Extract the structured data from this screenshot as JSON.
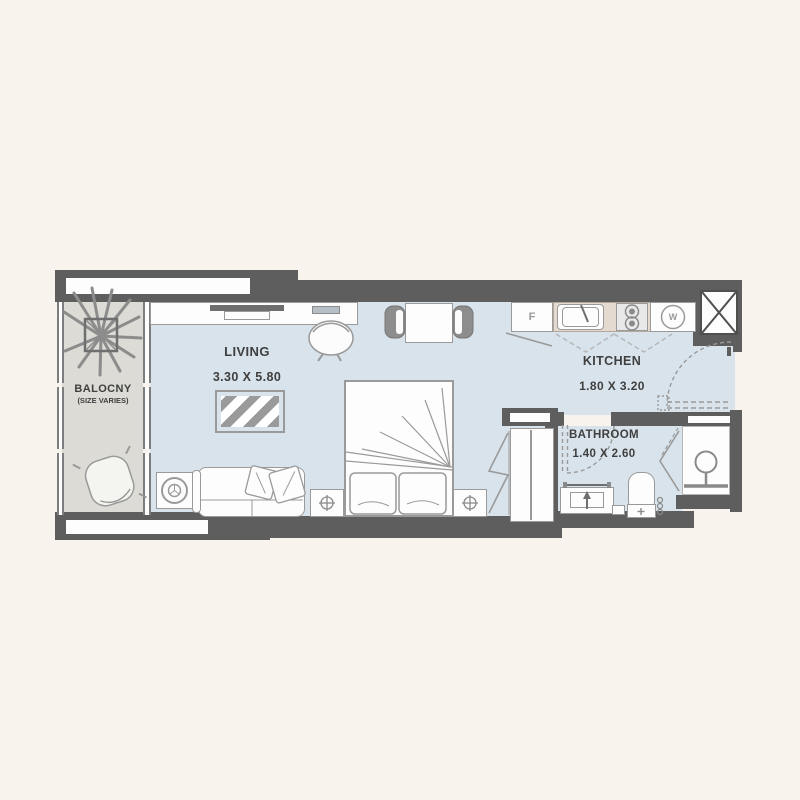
{
  "rooms": {
    "balcony": {
      "name": "BALOCNY",
      "note": "(SIZE VARIES)"
    },
    "living": {
      "name": "LIVING",
      "dims": "3.30 X 5.80"
    },
    "kitchen": {
      "name": "KITCHEN",
      "dims": "1.80 X 3.20"
    },
    "bathroom": {
      "name": "BATHROOM",
      "dims": "1.40 X 2.60"
    }
  },
  "appliances": {
    "fridge": "F",
    "washer": "W"
  },
  "colors": {
    "wall": "#5e5e5e",
    "floor": "#d8e3eb",
    "balcony_floor": "#dcdbd5",
    "counter": "#e5dacf",
    "background": "#f9f3ee",
    "line": "#8a8a8a",
    "text": "#3f3f3f"
  }
}
